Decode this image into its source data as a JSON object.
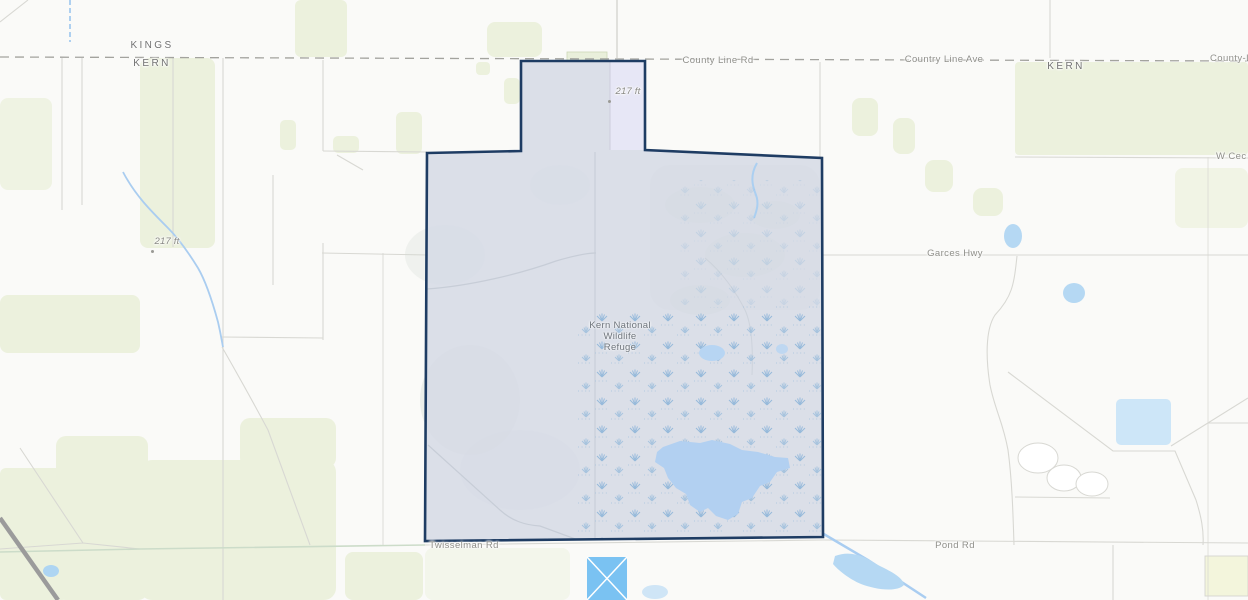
{
  "map": {
    "county_labels": {
      "kings": "KINGS",
      "kern_west": "KERN",
      "kern_east": "KERN"
    },
    "road_labels": {
      "county_line_rd": "County Line Rd",
      "country_line_ave": "Country Line Ave",
      "county_line_edge": "County-L",
      "w_cecil_edge": "W Cec",
      "garces_hwy": "Garces Hwy",
      "twisselman_rd": "Twisselman Rd",
      "pond_rd": "Pond Rd"
    },
    "elevation_labels": {
      "notch": "217 ft",
      "west": "217 ft"
    },
    "refuge_label": {
      "line1": "Kern National",
      "line2": "Wildlife",
      "line3": "Refuge"
    },
    "colors": {
      "refuge_fill": "#d6dae6",
      "refuge_outline": "#1e3c63",
      "parcel_fill": "#e9e9f8",
      "water": "#b5d8f3",
      "water_bright": "#7ac2f2",
      "marsh_symbol": "#8fb6d9",
      "farmland_green": "#ecf1dd",
      "road_gray": "#d8d8d3",
      "county_dash": "#a3a39e",
      "label_gray": "#8f8f89"
    }
  }
}
